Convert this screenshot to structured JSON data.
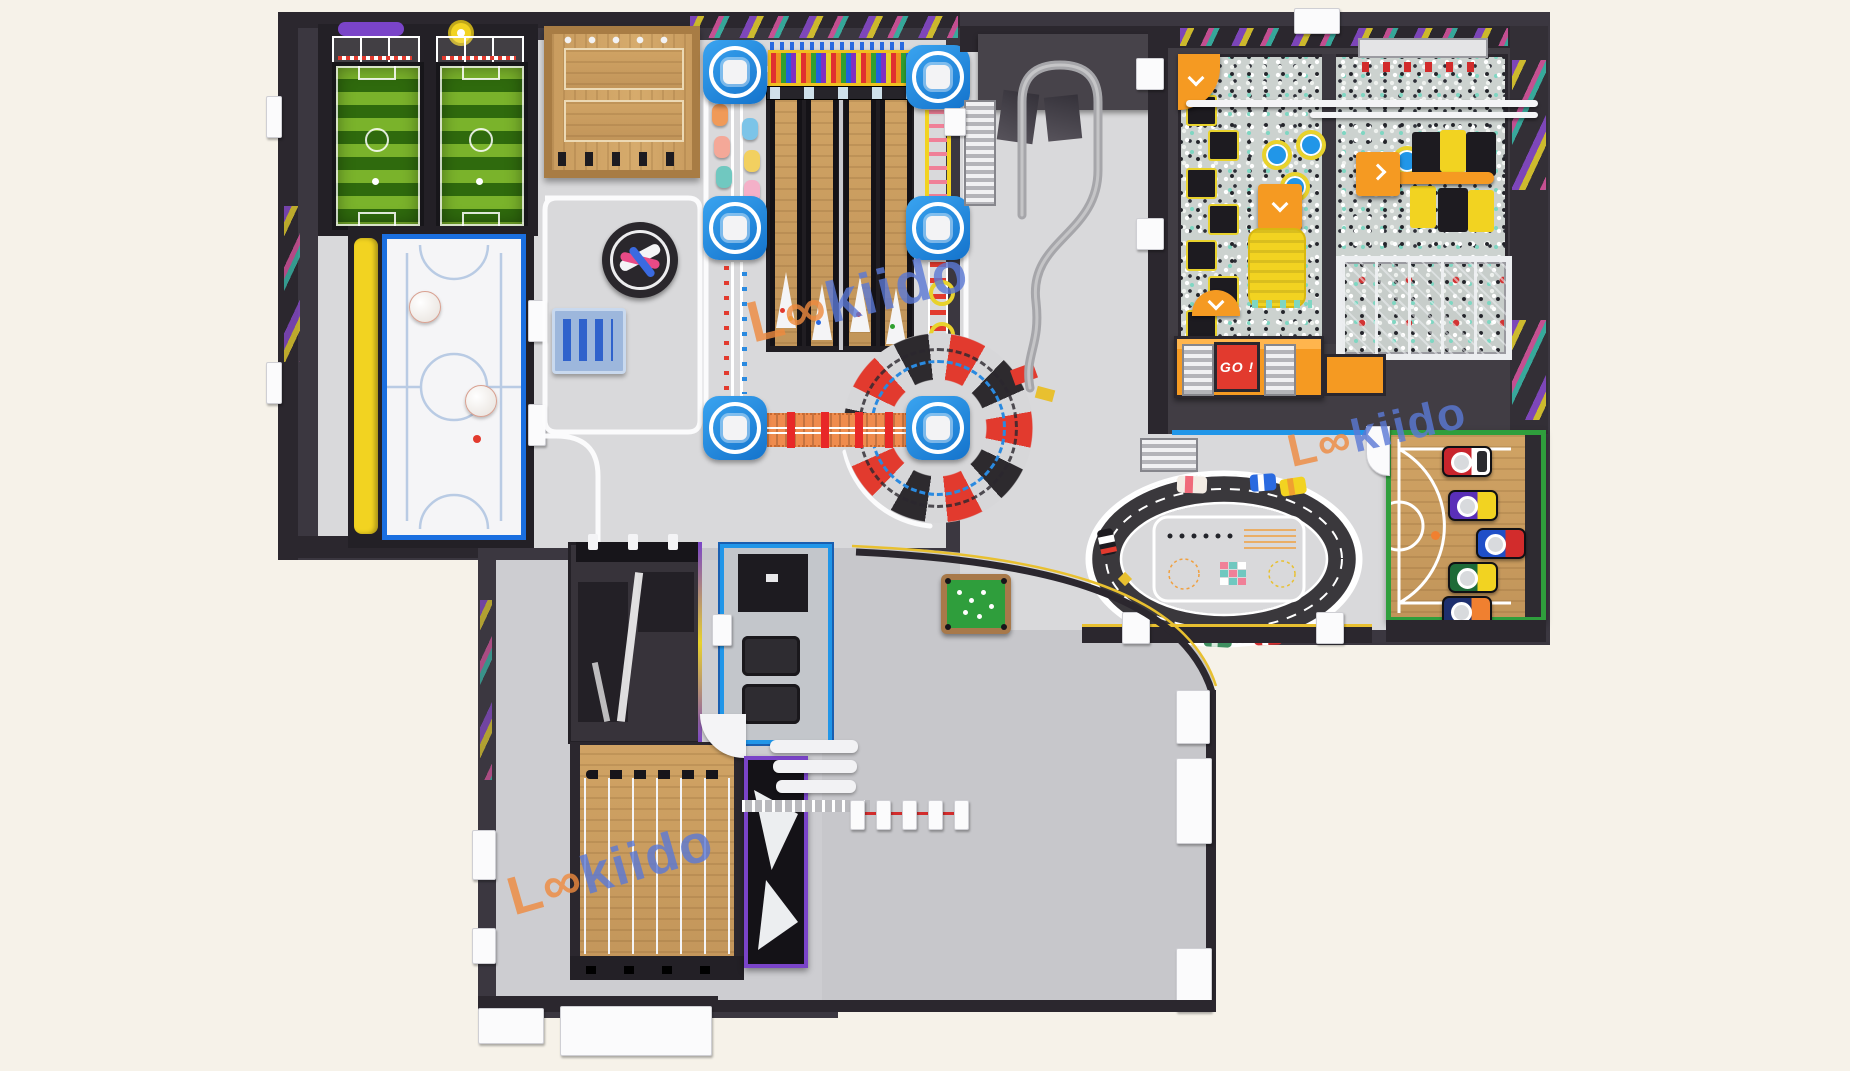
{
  "scene": {
    "description": "Top-down 3D render of an indoor family entertainment center (trampoline / adventure park) floor plan on a cream background",
    "width_px": 1850,
    "height_px": 1071
  },
  "watermark": {
    "brand": "Lookiido",
    "display_prefix": "L∞",
    "display_suffix": "kiido",
    "occurrences": 3
  },
  "signs": {
    "go_kart_sign": "GO !"
  },
  "icons": {
    "brand_chevron": "double-chevron-logo"
  },
  "palette": {
    "cream": "#f6f2e9",
    "wall": "#3b3740",
    "wallDark": "#2b272e",
    "charcoal": "#232026",
    "floor": "#d9d9db",
    "floorDim": "#cdcdd1",
    "lobby": "#c7c7cb",
    "white": "#ffffff",
    "blue": "#2196e8",
    "blueDeep": "#1473cc",
    "lightBlue": "#b9cbe4",
    "yellow": "#f2d321",
    "gold": "#e8d22c",
    "orange": "#f59a22",
    "orangeBridge": "#ef8c4e",
    "red": "#e23a2e",
    "green": "#2f9e3c",
    "pitchLight": "#7ab32b",
    "pitchDark": "#2f6a0d",
    "wood": "#c99c5f",
    "laneWood": "#dcb878",
    "woodDark": "#a87c44",
    "teal": "#7fd6c2",
    "purple": "#7a44c8",
    "pink": "#f2a0b4",
    "grayTrack": "#a6a6aa",
    "silver": "#c9c9ce",
    "wmOrange": "#ef8a3e",
    "wmBlue": "#5b79d6"
  },
  "zones": [
    {
      "id": "soccer-cage-courts",
      "color": "#7ab32b"
    },
    {
      "id": "bubble-ball-court",
      "color": "#2196e8"
    },
    {
      "id": "party-deck",
      "color": "#c99c5f"
    },
    {
      "id": "spinner-table",
      "color": "#232026"
    },
    {
      "id": "building-blocks-table",
      "color": "#2f62cc"
    },
    {
      "id": "ninja-course-towers",
      "color": "#1473cc"
    },
    {
      "id": "mini-bowling",
      "color": "#dcb878"
    },
    {
      "id": "rainbow-pin-rack",
      "color": "#e8d22c"
    },
    {
      "id": "pinwheel-ride",
      "color": "#e23a2e"
    },
    {
      "id": "rail-glider-track",
      "color": "#a6a6aa"
    },
    {
      "id": "ball-pit-arena",
      "color": "#7fd6c2"
    },
    {
      "id": "foam-pit",
      "color": "#c7cdca"
    },
    {
      "id": "go-deck-stairs",
      "color": "#f59a22"
    },
    {
      "id": "yellow-airbag",
      "color": "#f2d321"
    },
    {
      "id": "go-kart-track",
      "color": "#3a383c"
    },
    {
      "id": "basketball-shootout-court",
      "color": "#2f9e3c"
    },
    {
      "id": "billiard-table",
      "color": "#2f9e3c"
    },
    {
      "id": "vr-sim-room",
      "color": "#2196e8"
    },
    {
      "id": "dark-counter-room",
      "color": "#37333a"
    },
    {
      "id": "archery-range",
      "color": "#c99c5f"
    },
    {
      "id": "arcade-cabinet",
      "color": "#7a44c8"
    },
    {
      "id": "lobby",
      "color": "#c7c7cb"
    }
  ]
}
